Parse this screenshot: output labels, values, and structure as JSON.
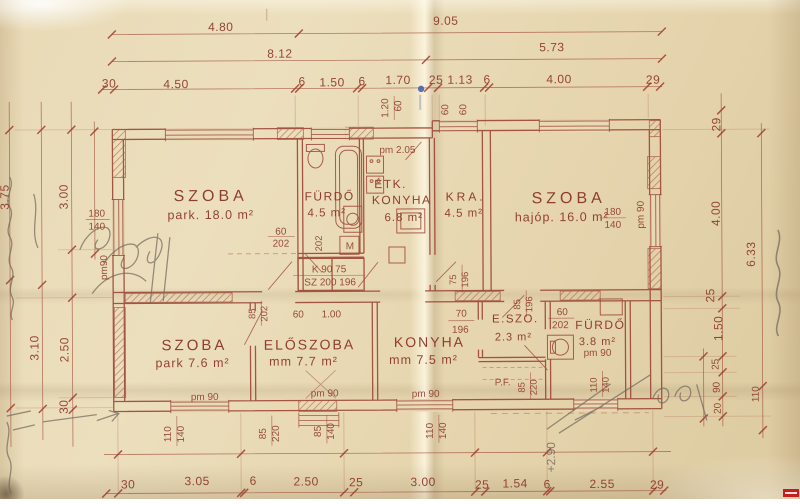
{
  "palette": {
    "ink_line": "#9c4636",
    "ink_text": "#8b3627",
    "pencil": "#6f675c",
    "paper": "#e7d7b2",
    "blue_mark": "#3c5fa8",
    "watermark_red": "#c41f1f"
  },
  "rooms": {
    "szoba18": {
      "name": "SZOBA",
      "spec": "park. 18.0 m²"
    },
    "furdo1": {
      "name": "FÜRDŐ",
      "spec": "4.5 m²"
    },
    "etk_konyha": {
      "line1": "ÉTK.",
      "line2": "KONYHA",
      "spec": "6.8 m²"
    },
    "kra": {
      "name": "KRA.",
      "spec": "4.5 m²"
    },
    "szoba16": {
      "name": "SZOBA",
      "spec": "hajóp. 16.0 m²"
    },
    "szoba76": {
      "name": "SZOBA",
      "spec": "park 7.6 m²"
    },
    "eloszoba": {
      "name": "ELŐSZOBA",
      "spec": "mm 7.7 m²"
    },
    "konyha2": {
      "name": "KONYHA",
      "spec": "mm 7.5 m²"
    },
    "eszo": {
      "name": "E.SZO.",
      "spec": "2.3 m²"
    },
    "furdo2": {
      "name": "FÜRDŐ",
      "spec": "3.8 m²",
      "pm": "pm 90"
    }
  },
  "dims": {
    "top1": [
      "4.80",
      "9.05"
    ],
    "top2": [
      "8.12",
      "5.73"
    ],
    "top3": [
      "30",
      "4.50",
      "6",
      "1.50",
      "6",
      "1.70",
      "25",
      "1.13",
      "6",
      "4.00",
      "29"
    ],
    "top_small": [
      "1.20",
      "60",
      "60",
      "60"
    ],
    "bottom": [
      "30",
      "3.05",
      "6",
      "2.50",
      "25",
      "3.00",
      "25",
      "1.54",
      "6",
      "2.55",
      "29"
    ],
    "bottom_pairs": [
      [
        "110",
        "140"
      ],
      [
        "85",
        "220"
      ],
      [
        "85",
        "140"
      ],
      [
        "110",
        "140"
      ]
    ],
    "left": [
      "3.75",
      "3.00",
      "3.10",
      "2.50",
      "30"
    ],
    "right": [
      "29",
      "4.00",
      "6.33",
      "25",
      "1.50"
    ],
    "right_lower": [
      "25",
      "90",
      "20",
      "110"
    ]
  },
  "openings": {
    "szoba18_door": [
      "60",
      "202"
    ],
    "furdo1_door": "202",
    "window_left": [
      "180",
      "140"
    ],
    "window_right": [
      "180",
      "140"
    ],
    "closet": [
      "K  90  75",
      "SZ 200 196"
    ],
    "kra_door": [
      "75",
      "196"
    ],
    "eloszoba_door": [
      "85",
      "196"
    ],
    "szoba76_door": [
      "85",
      "202"
    ],
    "hall_dim": [
      "60",
      "1.00"
    ],
    "konyha_door": [
      "70",
      "196"
    ],
    "furdo2_door": [
      "60",
      "202"
    ],
    "eszo_door": [
      "85",
      "220"
    ],
    "shaft": [
      "110",
      "140"
    ]
  },
  "annotations": {
    "pm205": "pm 2.05",
    "pm90_left": "pm90",
    "pm90_right": "pm 90",
    "pm90_szoba76": "pm 90",
    "pm90_eloszoba": "pm 90",
    "pm90_konyha": "pm 90",
    "pf": "P.F.",
    "m": "M",
    "pencil_note": "+2.90"
  }
}
